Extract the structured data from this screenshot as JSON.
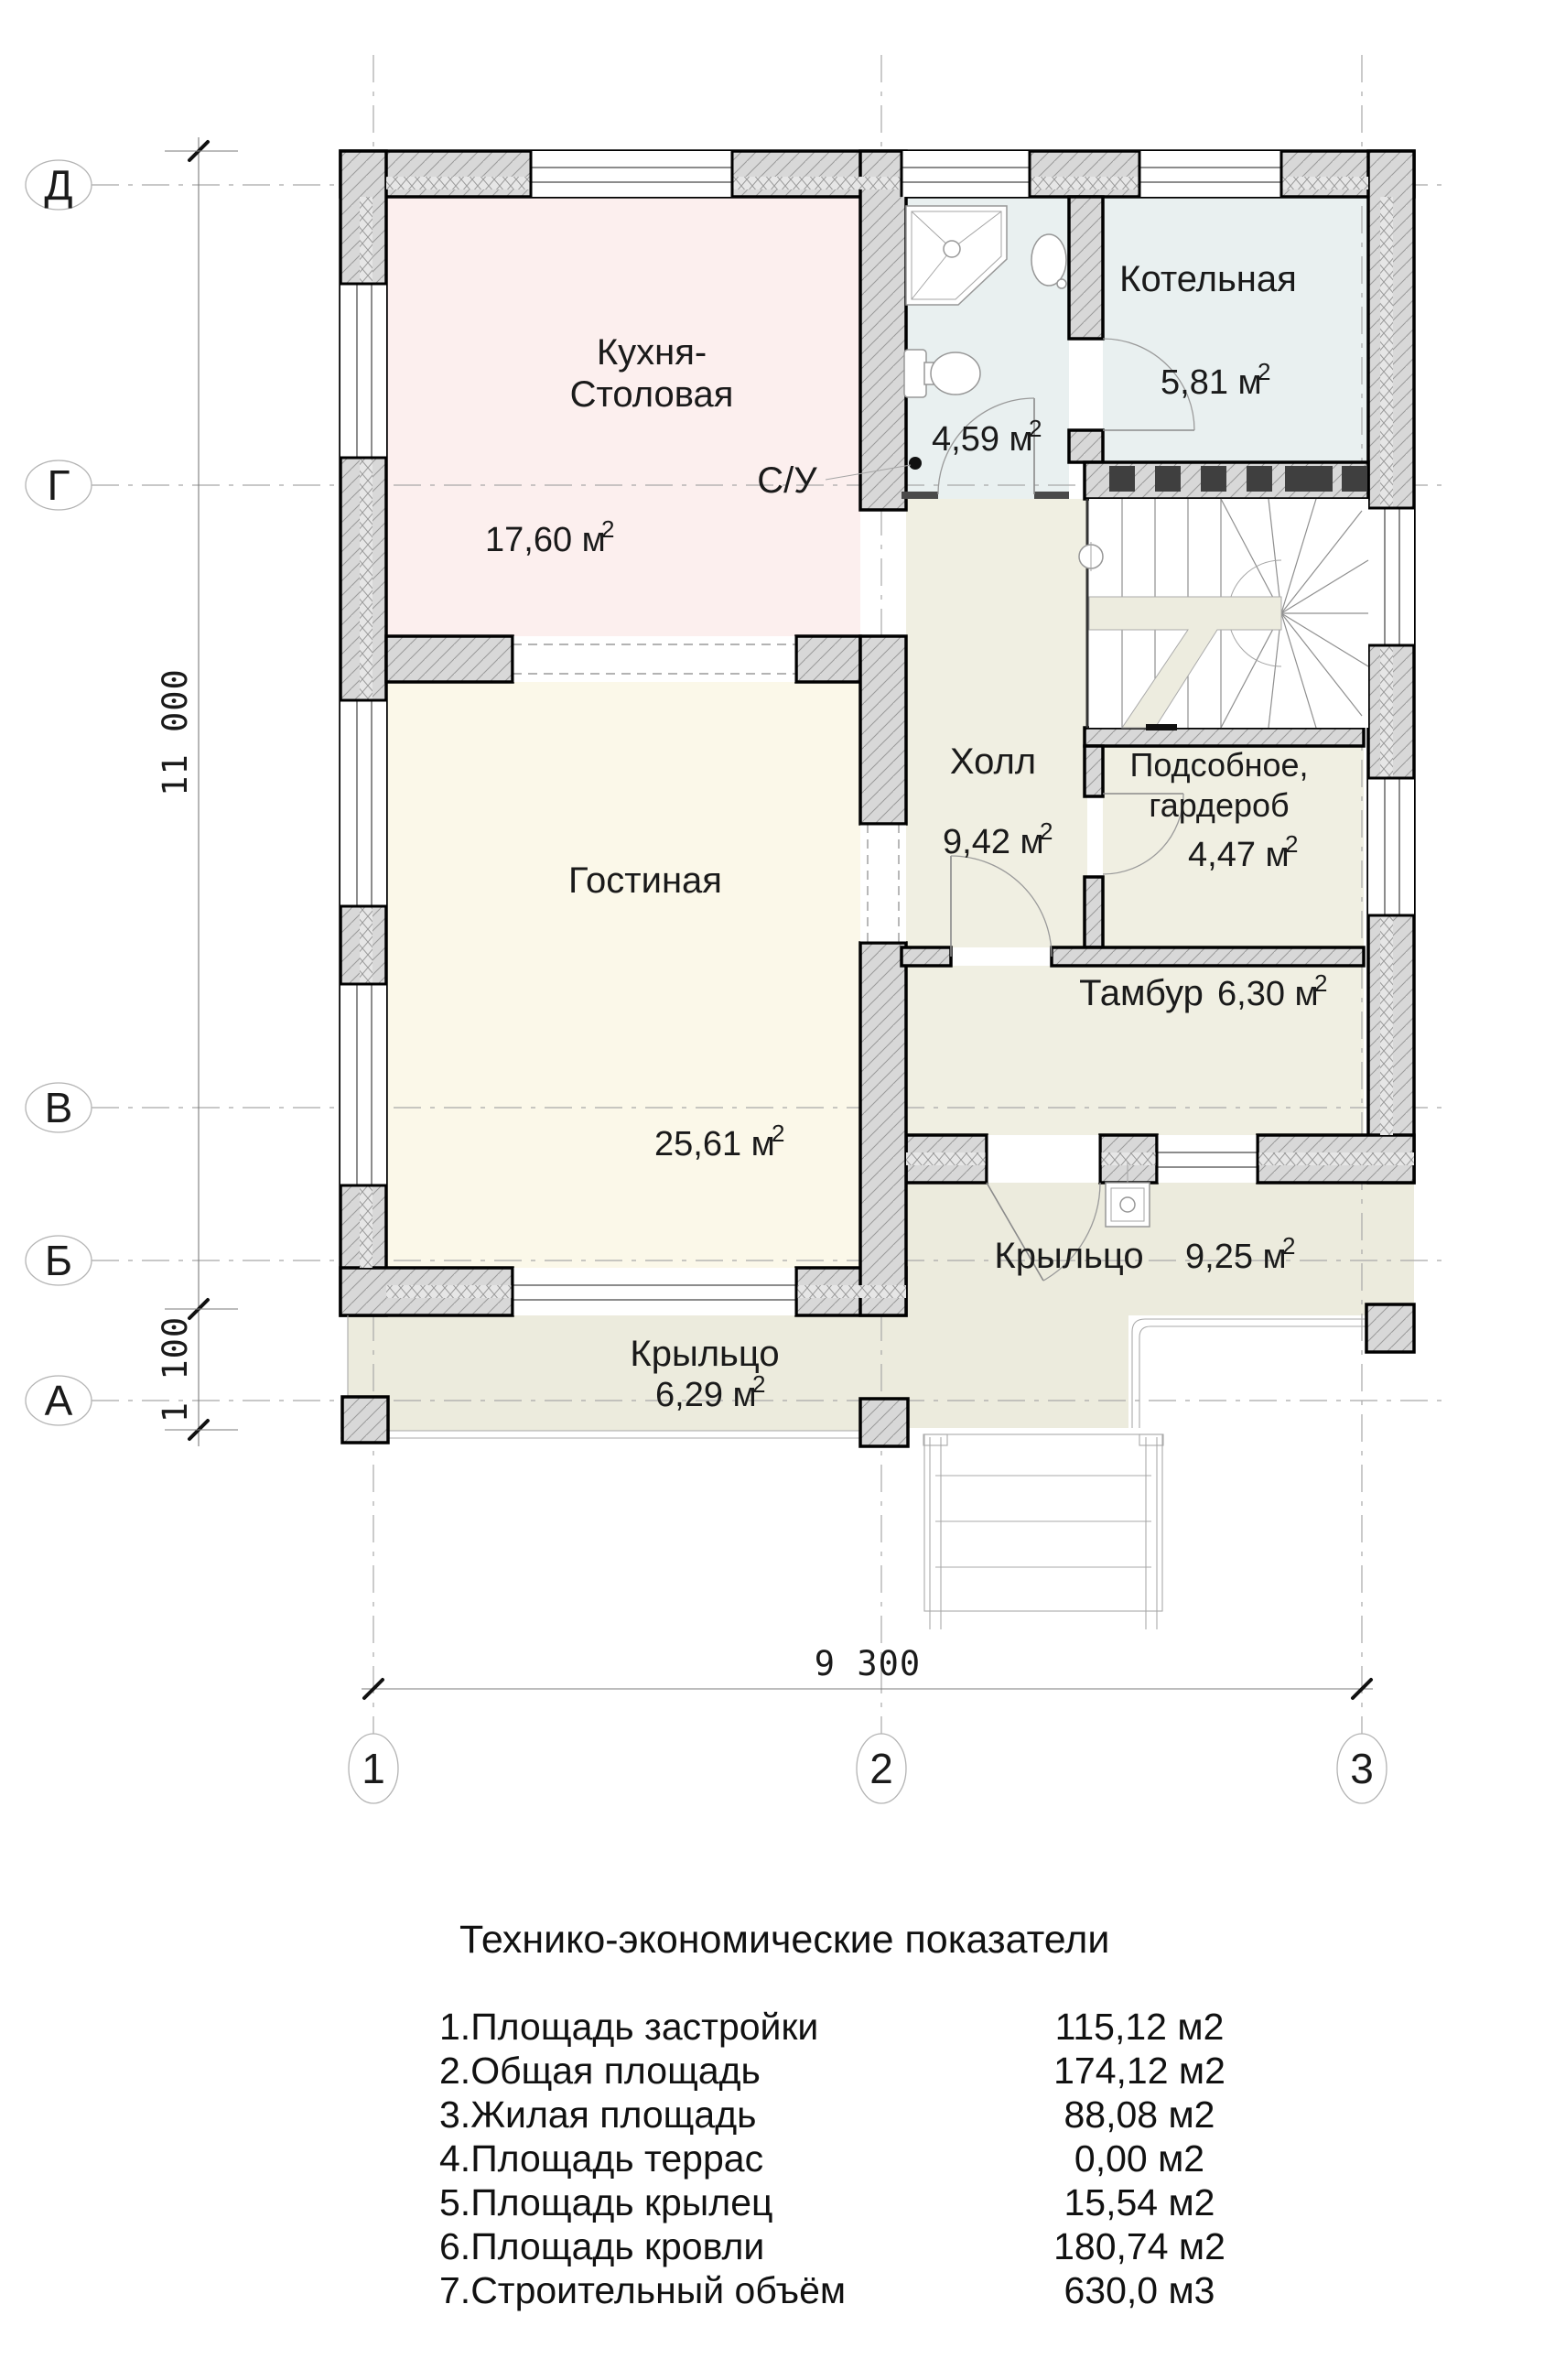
{
  "plan": {
    "axes": {
      "rows": [
        "Д",
        "Г",
        "В",
        "Б",
        "А"
      ],
      "cols": [
        "1",
        "2",
        "3"
      ]
    },
    "dims": {
      "total_height": "11 000",
      "porch_height": "1 100",
      "total_width": "9 300"
    },
    "rooms": {
      "kitchen": {
        "name1": "Кухня-",
        "name2": "Столовая",
        "area": "17,60 м",
        "sup": "2"
      },
      "wc": {
        "name": "С/У",
        "area": "4,59 м",
        "sup": "2"
      },
      "boiler": {
        "name": "Котельная",
        "area": "5,81 м",
        "sup": "2"
      },
      "hall": {
        "name": "Холл",
        "area": "9,42 м",
        "sup": "2"
      },
      "storage": {
        "name1": "Подсобное,",
        "name2": "гардероб",
        "area": "4,47 м",
        "sup": "2"
      },
      "tambour": {
        "name": "Тамбур",
        "area": "6,30 м",
        "sup": "2"
      },
      "living": {
        "name": "Гостиная",
        "area": "25,61 м",
        "sup": "2"
      },
      "porch_right": {
        "name": "Крыльцо",
        "area": "9,25 м",
        "sup": "2"
      },
      "porch_left": {
        "name": "Крыльцо",
        "area": "6,29 м",
        "sup": "2"
      }
    }
  },
  "table": {
    "title": "Технико-экономические показатели",
    "rows": [
      {
        "label": "1.Площадь застройки",
        "value": "115,12 м2"
      },
      {
        "label": "2.Общая площадь",
        "value": "174,12 м2"
      },
      {
        "label": "3.Жилая площадь",
        "value": "88,08 м2"
      },
      {
        "label": "4.Площадь террас",
        "value": "0,00 м2"
      },
      {
        "label": "5.Площадь крылец",
        "value": "15,54 м2"
      },
      {
        "label": "6.Площадь кровли",
        "value": "180,74 м2"
      },
      {
        "label": "7.Строительный объём",
        "value": "630,0 м3"
      }
    ]
  },
  "colors": {
    "kitchen_fill": "#fcefee",
    "wet_fill": "#e9f0f0",
    "beige_fill": "#f0efe2",
    "living_fill": "#fbf8e9",
    "porch_fill": "#ecebdd",
    "wall_fill": "#d8d8d8",
    "flue": "#3f3f3f"
  }
}
